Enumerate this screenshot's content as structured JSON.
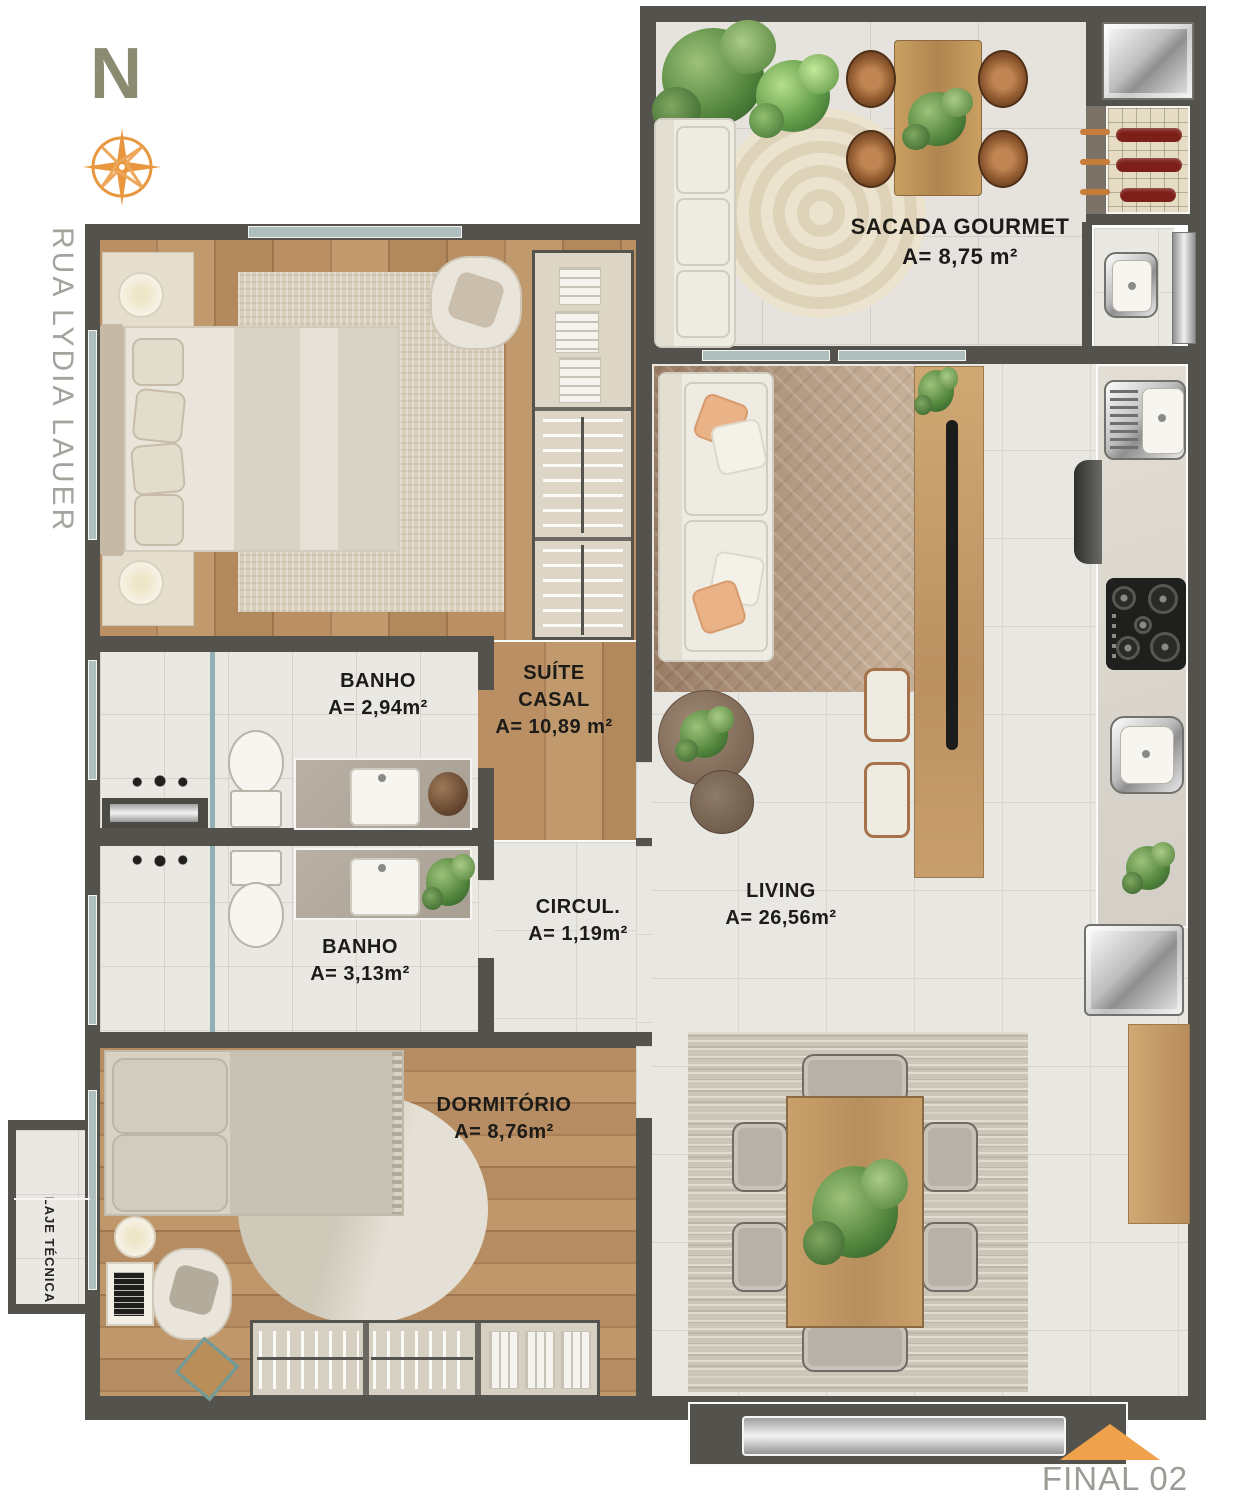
{
  "title": "Apartment floor plan",
  "compass": {
    "letter": "N"
  },
  "street": {
    "label": "RUA LYDIA LAUER"
  },
  "rooms": {
    "sacada_gourmet": {
      "name": "SACADA GOURMET",
      "area": "A= 8,75 m²"
    },
    "suite_casal": {
      "name": "SUÍTE CASAL",
      "area": "A= 10,89 m²"
    },
    "banho_suite": {
      "name": "BANHO",
      "area": "A= 2,94m²"
    },
    "banho_social": {
      "name": "BANHO",
      "area": "A= 3,13m²"
    },
    "circulacao": {
      "name": "CIRCUL.",
      "area": "A= 1,19m²"
    },
    "living": {
      "name": "LIVING",
      "area": "A= 26,56m²"
    },
    "dormitorio": {
      "name": "DORMITÓRIO",
      "area": "A= 8,76m²"
    },
    "laje_tecnica": {
      "name": "LAJE TÉCNICA"
    }
  },
  "unit": {
    "label": "FINAL 02"
  },
  "colors": {
    "wall": "#54524c",
    "wood_floor": "#b28a5f",
    "tile_floor": "#e9e7e2",
    "accent_orange": "#efa14c",
    "compass_orange": "#e8973f",
    "north_letter": "#8b8b72",
    "muted_text": "#a0a09a",
    "label_text": "#1c1b18"
  }
}
